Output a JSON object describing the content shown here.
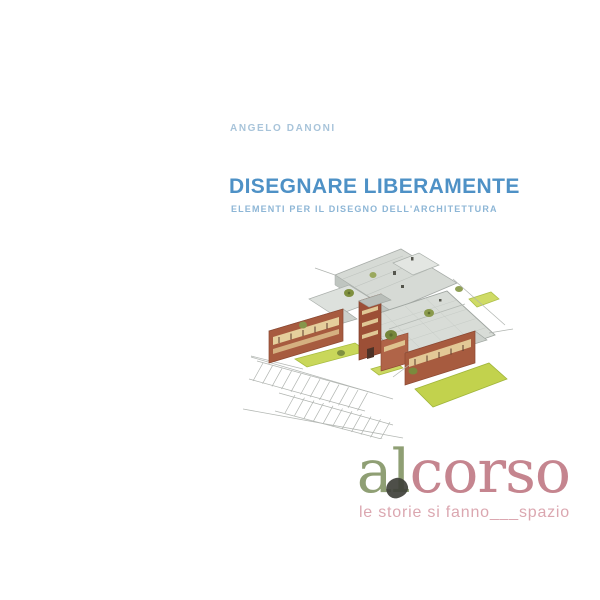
{
  "page": {
    "background_color": "#ffffff",
    "type": "book-cover"
  },
  "cover": {
    "author": "ANGELO DANONI",
    "author_color": "#a8c4da",
    "title": "DISEGNARE LIBERAMENTE",
    "title_color": "#4e91c6",
    "subtitle": "ELEMENTI PER IL DISEGNO DELL'ARCHITETTURA",
    "subtitle_color": "#8db6d6",
    "illustration": {
      "description": "Hand-drawn axonometric watercolor sketch of a brick building complex with gray hatched roofs, cream window bands, olive-green trees, yellow-green lawns and a pencil-sketched parking lot at lower left",
      "brick_color": "#a75b3f",
      "roof_color": "#d8dcd7",
      "lawn_color": "#c2d24d",
      "tree_color": "#7f903f",
      "sketch_line_color": "#aeb2ae"
    },
    "publisher": {
      "name_part1": "al",
      "name_part2": "corso",
      "name_part1_color": "#8f9f74",
      "name_part2_color": "#c5858f",
      "blob_color": "#3f403a",
      "tagline": "le storie si fanno___spazio",
      "tagline_color": "#dba7b0"
    }
  }
}
